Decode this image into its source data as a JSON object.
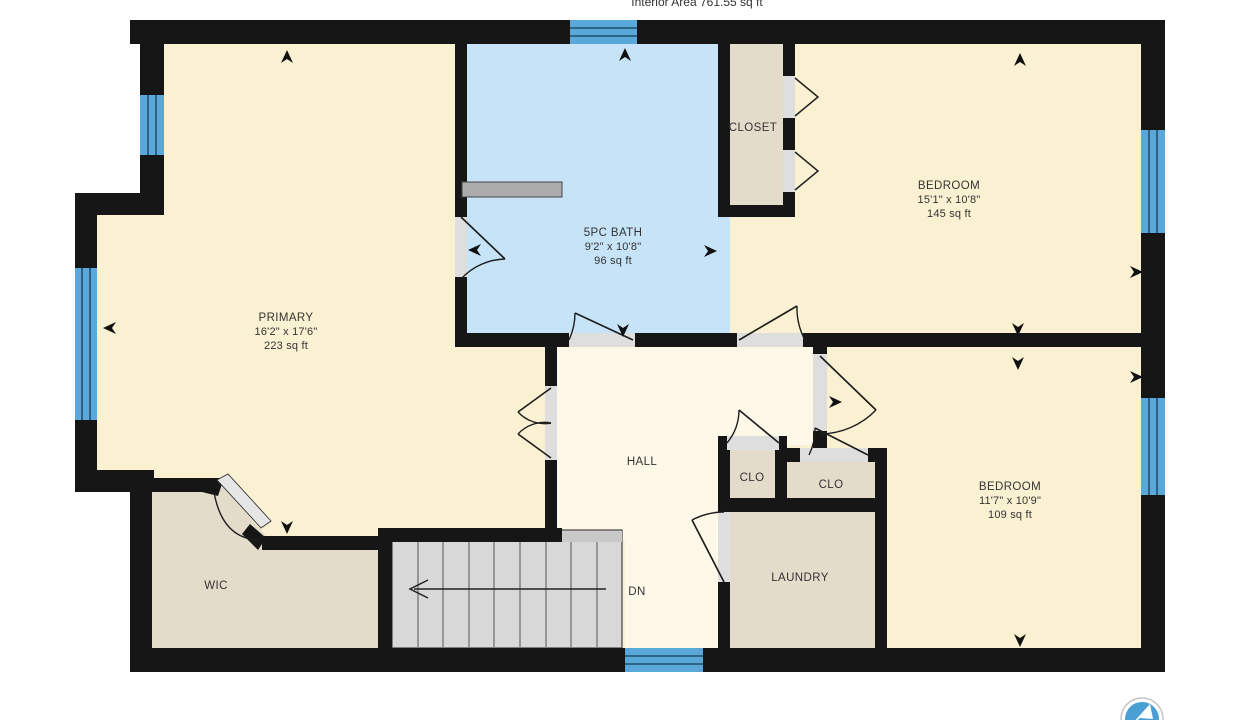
{
  "title": {
    "interior_area": "Interior Area 761.55 sq ft"
  },
  "rooms": {
    "primary": {
      "name": "PRIMARY",
      "dims": "16'2\" x 17'6\"",
      "area": "223 sq ft"
    },
    "bath": {
      "name": "5PC BATH",
      "dims": "9'2\" x 10'8\"",
      "area": "96 sq ft"
    },
    "closet": {
      "name": "CLOSET"
    },
    "bedroom1": {
      "name": "BEDROOM",
      "dims": "15'1\" x 10'8\"",
      "area": "145 sq ft"
    },
    "bedroom2": {
      "name": "BEDROOM",
      "dims": "11'7\" x 10'9\"",
      "area": "109 sq ft"
    },
    "hall": {
      "name": "HALL"
    },
    "clo1": {
      "name": "CLO"
    },
    "clo2": {
      "name": "CLO"
    },
    "laundry": {
      "name": "LAUNDRY"
    },
    "wic": {
      "name": "WIC"
    }
  },
  "stairs": {
    "dn_label": "DN"
  },
  "colors": {
    "wall": "#161616",
    "bedroom_fill": "#faf1d2",
    "hall_fill": "#fdf8e7",
    "bath_fill": "#c6e3f8",
    "closet_fill": "#e4dcca",
    "stairs_fill": "#d8d8d8",
    "window_blue": "#58a8da",
    "door_gap": "#dedede",
    "logo_blue": "#4aa0d5"
  }
}
